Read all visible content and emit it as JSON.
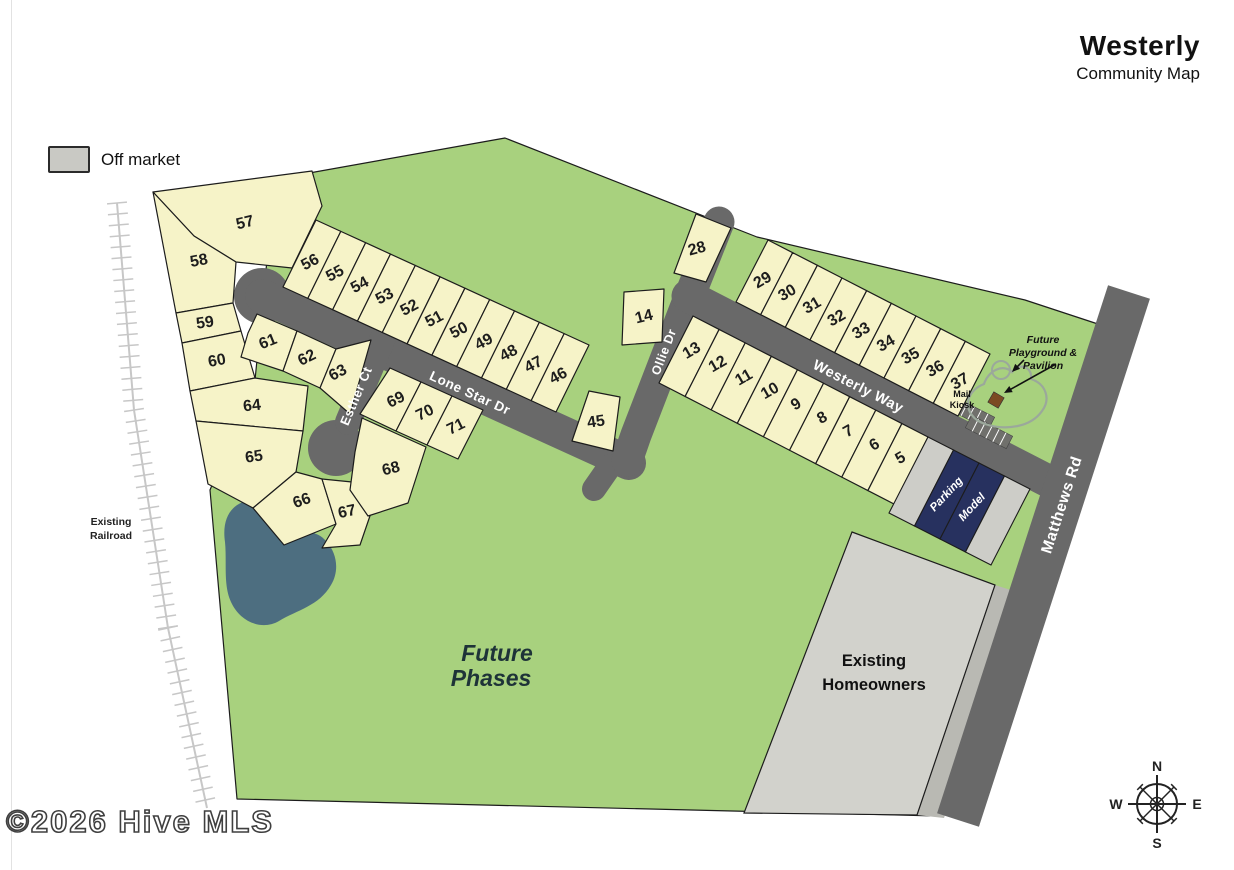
{
  "header": {
    "title": "Westerly",
    "subtitle": "Community Map"
  },
  "legend": {
    "off_market_label": "Off market"
  },
  "watermark": "©2026 Hive MLS",
  "compass": {
    "north": "N",
    "east": "E",
    "south": "S",
    "west": "W"
  },
  "streets": {
    "lone_star": "Lone Star Dr",
    "esther": "Esther Ct",
    "ollie": "Ollie Dr",
    "westerly_way": "Westerly Way",
    "matthews": "Matthews Rd"
  },
  "labels": {
    "future_phases_line1": "Future",
    "future_phases_line2": "Phases",
    "existing_homeowners_line1": "Existing",
    "existing_homeowners_line2": "Homeowners",
    "existing_railroad_line1": "Existing",
    "existing_railroad_line2": "Railroad",
    "playground_line1": "Future",
    "playground_line2": "Playground &",
    "playground_line3": "Pavilion",
    "mail_kiosk_line1": "Mail",
    "mail_kiosk_line2": "Kiosk",
    "parking": "Parking",
    "model": "Model"
  },
  "lots": {
    "cluster": [
      "57",
      "58",
      "59",
      "60",
      "61",
      "62",
      "63",
      "64",
      "65",
      "66",
      "67",
      "68",
      "69",
      "70",
      "71"
    ],
    "lone_star_north": [
      "56",
      "55",
      "54",
      "53",
      "52",
      "51",
      "50",
      "49",
      "48",
      "47",
      "46"
    ],
    "westerly_north": [
      "29",
      "30",
      "31",
      "32",
      "33",
      "34",
      "35",
      "36",
      "37"
    ],
    "westerly_south": [
      "13",
      "12",
      "11",
      "10",
      "9",
      "8",
      "7",
      "6",
      "5"
    ],
    "standalone": [
      "28",
      "14",
      "45"
    ]
  },
  "colors": {
    "greenspace": "#a8d17e",
    "lot_fill": "#f6f3c8",
    "road": "#696969",
    "off_market": "#cdcdc8",
    "homeowners": "#d2d2cc",
    "road_shoulder": "#b9b9b3",
    "model_navy": "#27315f",
    "pond": "#4d6e80",
    "railroad": "#c7c7c7",
    "outline": "#1c1c1c",
    "trail": "#9ba89b",
    "kiosk_brown": "#7b4a22"
  }
}
